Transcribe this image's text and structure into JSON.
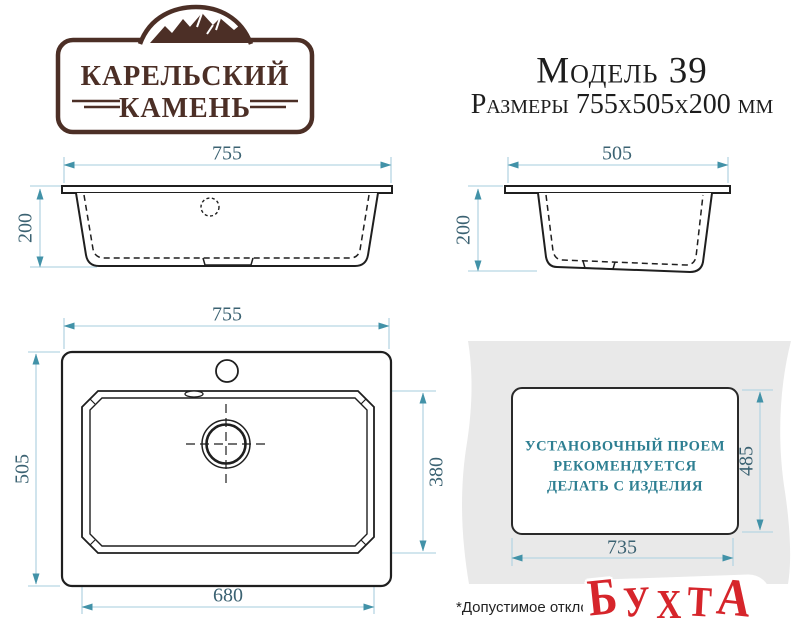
{
  "brand": {
    "name_line1": "КАРЕЛЬСКИЙ",
    "name_line2": "КАМЕНЬ"
  },
  "header": {
    "model": "Модель 39",
    "size_line": "Размеры 755х505х200 мм"
  },
  "front_view": {
    "width": "755",
    "height": "200"
  },
  "side_view": {
    "depth": "505",
    "height": "200"
  },
  "top_view": {
    "width": "755",
    "depth": "505",
    "bowl_width": "680",
    "bowl_depth": "380"
  },
  "cutout": {
    "width": "735",
    "depth": "485",
    "note": [
      "УСТАНОВОЧНЫЙ ПРОЕМ",
      "РЕКОМЕНДУЕТСЯ",
      "ДЕЛАТЬ С ИЗДЕЛИЯ"
    ]
  },
  "footer": {
    "disclaimer": "*Допустимое отклоне",
    "watermark": "БУХТА",
    "watermark_letters": [
      "Б",
      "У",
      "Х",
      "Т",
      "А"
    ]
  },
  "colors": {
    "line_ink": "#1f1f1f",
    "dimension_line": "#b7d6e3",
    "dimension_arrow": "#4292a8",
    "dimension_text": "#3b6272",
    "note_teal": "#2e7f92",
    "brand_brown": "#4c2f26",
    "watermark_red": "#d6252b",
    "countertop_gray": "#e9e9e9"
  }
}
